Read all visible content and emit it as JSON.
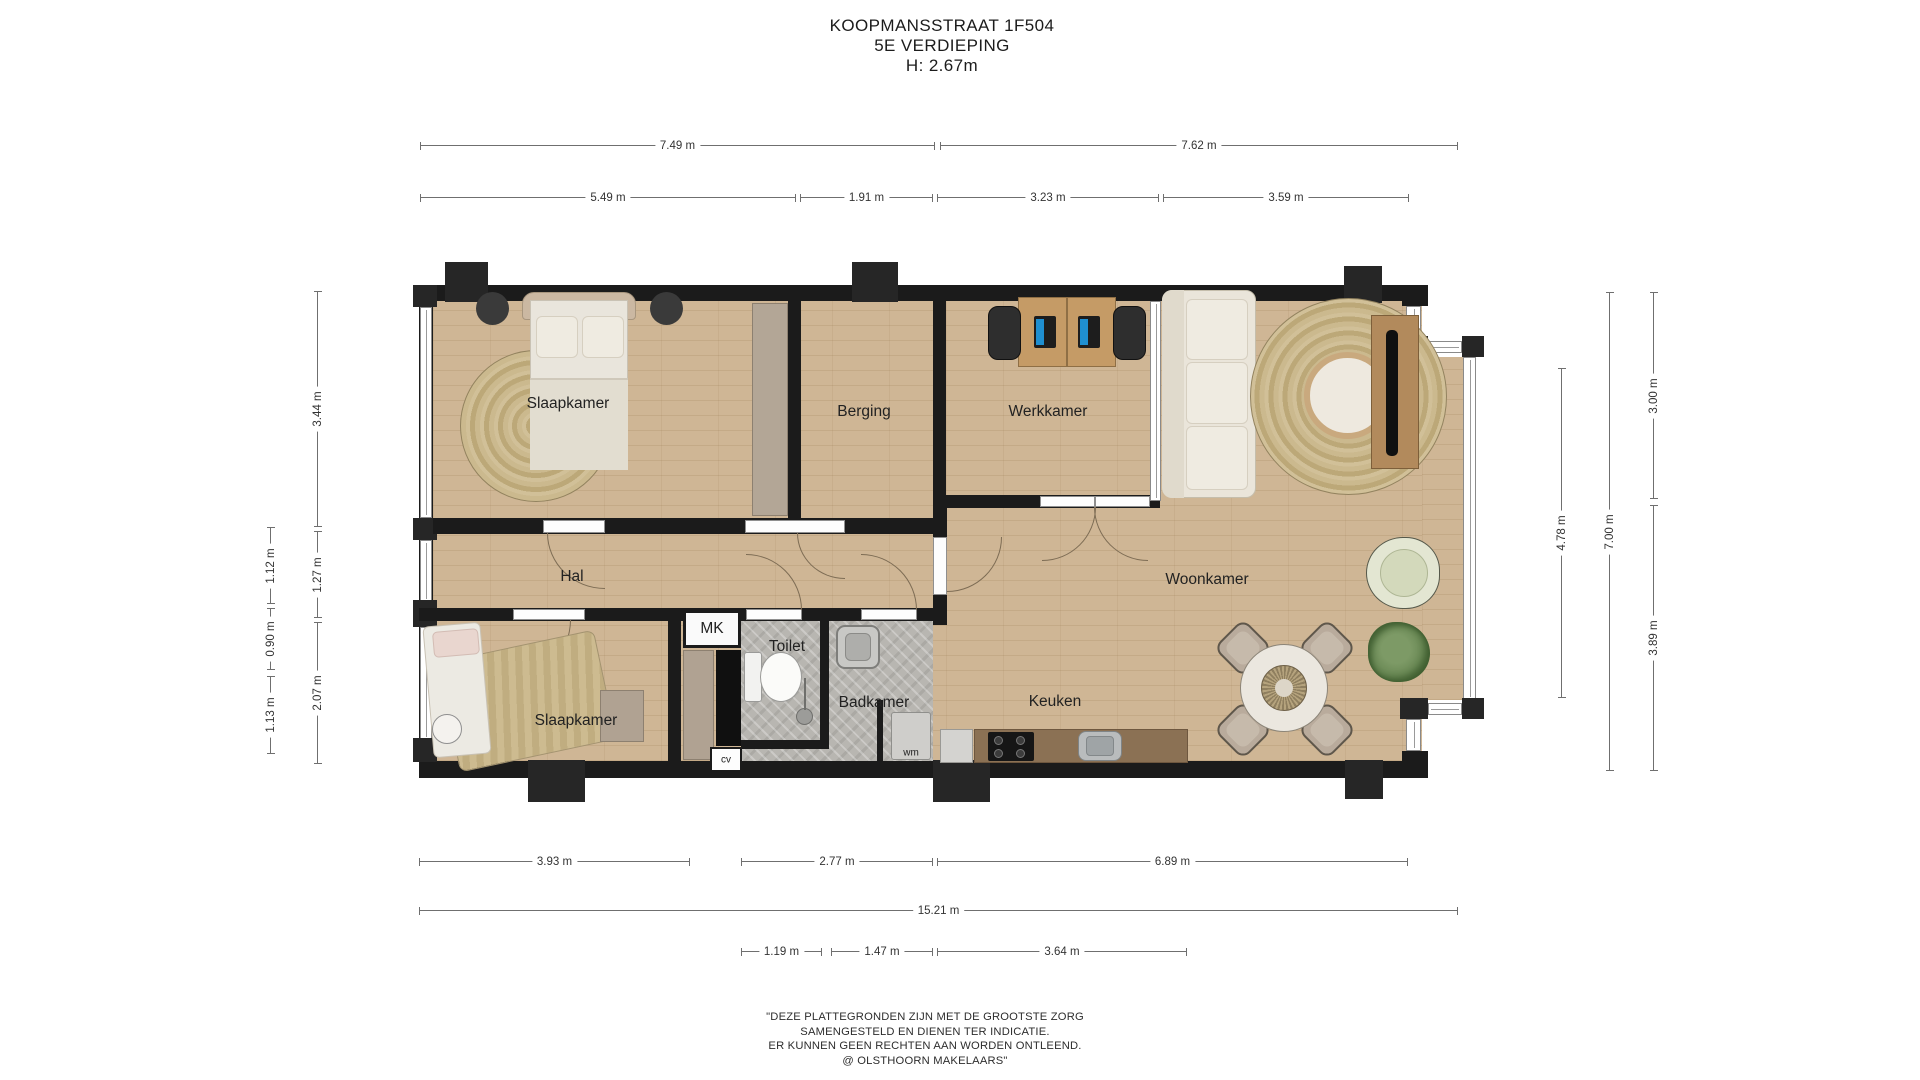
{
  "header": {
    "line1": "KOOPMANSSTRAAT 1F504",
    "line2": "5E VERDIEPING",
    "line3": "H: 2.67m"
  },
  "rooms": {
    "slaapkamer1": "Slaapkamer",
    "berging": "Berging",
    "werkkamer": "Werkkamer",
    "woonkamer": "Woonkamer",
    "hal": "Hal",
    "mk": "MK",
    "toilet": "Toilet",
    "badkamer": "Badkamer",
    "slaapkamer2": "Slaapkamer",
    "keuken": "Keuken",
    "cv": "cv",
    "wm": "wm"
  },
  "dims": {
    "top": [
      "7.49 m",
      "7.62 m",
      "5.49 m",
      "1.91 m",
      "3.23 m",
      "3.59 m"
    ],
    "left": [
      "3.44 m",
      "1.27 m",
      "2.07 m",
      "1.12 m",
      "0.90 m",
      "1.13 m"
    ],
    "right": [
      "4.78 m",
      "7.00 m",
      "3.00 m",
      "3.89 m"
    ],
    "bottom": [
      "3.93 m",
      "2.77 m",
      "6.89 m",
      "15.21 m",
      "1.19 m",
      "1.47 m",
      "3.64 m"
    ]
  },
  "disclaimer": {
    "line1": "\"DEZE PLATTEGRONDEN ZIJN MET DE GROOTSTE ZORG",
    "line2": "SAMENGESTELD EN DIENEN TER INDICATIE.",
    "line3": "ER KUNNEN GEEN RECHTEN AAN WORDEN ONTLEEND.",
    "line4": "@ OLSTHOORN MAKELAARS\""
  },
  "colors": {
    "wall": "#1b1b1b",
    "floor_wood": "#cfb695",
    "tile_grey": "#b8b6b1",
    "counter_wood": "#8b7154",
    "laptop_screen": "#1f8fd0"
  }
}
